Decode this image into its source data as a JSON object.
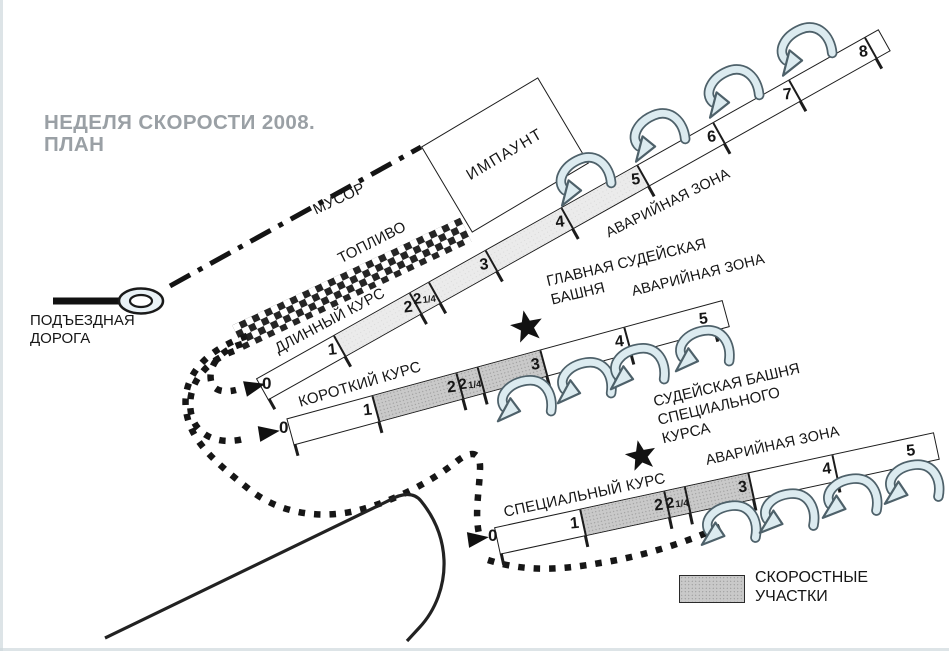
{
  "title": {
    "line1": "НЕДЕЛЯ СКОРОСТИ 2008.",
    "line2": "ПЛАН"
  },
  "impound": {
    "label": "ИМПАУНТ"
  },
  "paths": {
    "trash_label": "МУСОР",
    "fuel_label": "ТОПЛИВО"
  },
  "access_road": {
    "line1": "ПОДЪЕЗДНАЯ",
    "line2": "ДОРОГА"
  },
  "towers": {
    "main": {
      "line1": "ГЛАВНАЯ СУДЕЙСКАЯ",
      "line2": "БАШНЯ"
    },
    "special": {
      "line1": "СУДЕЙСКАЯ БАШНЯ",
      "line2": "СПЕЦИАЛЬНОГО",
      "line3": "КУРСА"
    }
  },
  "legend": {
    "line1": "СКОРОСТНЫЕ",
    "line2": "УЧАСТКИ"
  },
  "courses": {
    "long": {
      "name": "ДЛИННЫЙ КУРС",
      "hazard": "АВАРИЙНАЯ ЗОНА",
      "start_label": "0",
      "markers": [
        {
          "label": "1"
        },
        {
          "label": "2"
        },
        {
          "label": "2",
          "frac": "1/4"
        },
        {
          "label": "3"
        },
        {
          "label": "4"
        },
        {
          "label": "5"
        },
        {
          "label": "6"
        },
        {
          "label": "7"
        },
        {
          "label": "8"
        }
      ]
    },
    "short": {
      "name": "КОРОТКИЙ КУРС",
      "hazard": "АВАРИЙНАЯ ЗОНА",
      "start_label": "0",
      "markers": [
        {
          "label": "1"
        },
        {
          "label": "2"
        },
        {
          "label": "2",
          "frac": "1/4"
        },
        {
          "label": "3"
        },
        {
          "label": "4"
        },
        {
          "label": "5"
        }
      ]
    },
    "special": {
      "name": "СПЕЦИАЛЬНЫЙ КУРС",
      "hazard": "АВАРИЙНАЯ ЗОНА",
      "start_label": "0",
      "markers": [
        {
          "label": "1"
        },
        {
          "label": "2"
        },
        {
          "label": "2",
          "frac": "1/4"
        },
        {
          "label": "3"
        },
        {
          "label": "4"
        },
        {
          "label": "5"
        }
      ]
    }
  },
  "icons": {
    "star": "judges-tower-star",
    "uturn": "u-turn-left-arrow",
    "start": "start-direction-arrow",
    "roundabout": "road-end-oval"
  },
  "colors": {
    "speed_section": "#c9c9c9",
    "speed_section_light": "#ebebeb",
    "arrow_fill": "#dcebf0",
    "arrow_stroke": "#4e616a",
    "title_gray": "#9aa0a5"
  }
}
